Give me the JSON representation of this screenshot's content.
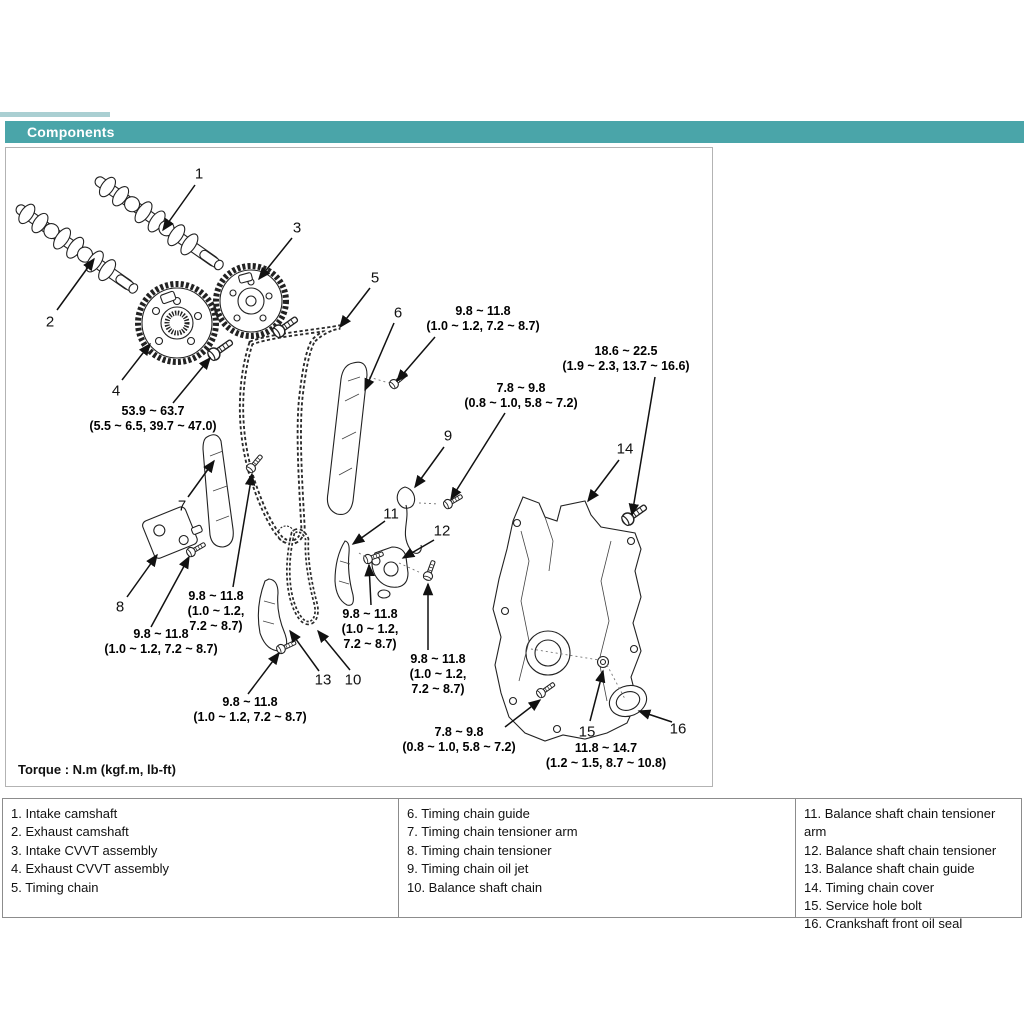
{
  "header": {
    "title": "Components",
    "bar_color": "#4aa5a9",
    "text_color": "#ffffff"
  },
  "diagram": {
    "torque_note": "Torque : N.m (kgf.m, lb-ft)",
    "callouts": [
      {
        "n": "1",
        "x": 198,
        "y": 173,
        "arrow": [
          194,
          184,
          162,
          229
        ]
      },
      {
        "n": "2",
        "x": 49,
        "y": 321,
        "arrow": [
          56,
          309,
          93,
          258
        ]
      },
      {
        "n": "3",
        "x": 296,
        "y": 227,
        "arrow": [
          291,
          237,
          258,
          278
        ]
      },
      {
        "n": "4",
        "x": 115,
        "y": 390,
        "arrow": [
          121,
          379,
          149,
          343
        ]
      },
      {
        "n": "5",
        "x": 374,
        "y": 277,
        "arrow": [
          369,
          287,
          339,
          326
        ]
      },
      {
        "n": "6",
        "x": 397,
        "y": 312,
        "arrow": [
          393,
          322,
          364,
          389
        ]
      },
      {
        "n": "7",
        "x": 181,
        "y": 505,
        "arrow": [
          187,
          496,
          213,
          460
        ]
      },
      {
        "n": "8",
        "x": 119,
        "y": 606,
        "arrow": [
          126,
          596,
          156,
          554
        ]
      },
      {
        "n": "9",
        "x": 447,
        "y": 435,
        "arrow": [
          443,
          446,
          414,
          486
        ]
      },
      {
        "n": "10",
        "x": 352,
        "y": 679,
        "arrow": [
          349,
          669,
          317,
          630
        ]
      },
      {
        "n": "11",
        "x": 390,
        "y": 513,
        "arrow": [
          384,
          520,
          352,
          543
        ]
      },
      {
        "n": "12",
        "x": 441,
        "y": 530,
        "arrow": [
          433,
          539,
          402,
          557
        ]
      },
      {
        "n": "13",
        "x": 322,
        "y": 679,
        "arrow": [
          318,
          670,
          289,
          630
        ]
      },
      {
        "n": "14",
        "x": 624,
        "y": 448,
        "arrow": [
          618,
          459,
          587,
          500
        ]
      },
      {
        "n": "15",
        "x": 586,
        "y": 731,
        "arrow": [
          589,
          720,
          602,
          670
        ]
      },
      {
        "n": "16",
        "x": 677,
        "y": 728,
        "arrow": [
          671,
          721,
          638,
          710
        ]
      }
    ],
    "torque_labels": [
      {
        "lines": [
          "53.9 ~ 63.7",
          "(5.5 ~ 6.5, 39.7 ~ 47.0)"
        ],
        "cx": 152,
        "y": 403,
        "arrow": [
          172,
          402,
          209,
          357
        ]
      },
      {
        "lines": [
          "9.8 ~ 11.8",
          "(1.0 ~ 1.2, 7.2 ~ 8.7)"
        ],
        "cx": 482,
        "y": 303,
        "arrow": [
          434,
          336,
          396,
          380
        ]
      },
      {
        "lines": [
          "18.6 ~ 22.5",
          "(1.9 ~ 2.3, 13.7 ~ 16.6)"
        ],
        "cx": 625,
        "y": 343,
        "arrow": [
          654,
          376,
          631,
          514
        ]
      },
      {
        "lines": [
          "7.8 ~ 9.8",
          "(0.8 ~ 1.0, 5.8 ~ 7.2)"
        ],
        "cx": 520,
        "y": 380,
        "arrow": [
          504,
          412,
          450,
          498
        ]
      },
      {
        "lines": [
          "9.8 ~ 11.8",
          "(1.0 ~ 1.2,",
          "7.2 ~ 8.7)"
        ],
        "cx": 215,
        "y": 588,
        "arrow": [
          232,
          586,
          251,
          473
        ]
      },
      {
        "lines": [
          "9.8 ~ 11.8",
          "(1.0 ~ 1.2, 7.2 ~ 8.7)"
        ],
        "cx": 160,
        "y": 626,
        "arrow": [
          150,
          626,
          188,
          556
        ]
      },
      {
        "lines": [
          "9.8 ~ 11.8",
          "(1.0 ~ 1.2,",
          "7.2 ~ 8.7)"
        ],
        "cx": 369,
        "y": 606,
        "arrow": [
          370,
          604,
          368,
          564
        ]
      },
      {
        "lines": [
          "9.8 ~ 11.8",
          "(1.0 ~ 1.2,",
          "7.2 ~ 8.7)"
        ],
        "cx": 437,
        "y": 651,
        "arrow": [
          427,
          649,
          427,
          583
        ]
      },
      {
        "lines": [
          "9.8 ~ 11.8",
          "(1.0 ~ 1.2, 7.2 ~ 8.7)"
        ],
        "cx": 249,
        "y": 694,
        "arrow": [
          247,
          693,
          278,
          652
        ]
      },
      {
        "lines": [
          "7.8 ~ 9.8",
          "(0.8 ~ 1.0, 5.8 ~ 7.2)"
        ],
        "cx": 458,
        "y": 724,
        "arrow": [
          504,
          726,
          539,
          699
        ]
      },
      {
        "lines": [
          "11.8 ~ 14.7",
          "(1.2 ~ 1.5, 8.7 ~ 10.8)"
        ],
        "cx": 605,
        "y": 740,
        "arrow": null
      }
    ]
  },
  "legend": {
    "columns": [
      {
        "items": [
          "1. Intake camshaft",
          "2. Exhaust camshaft",
          "3. Intake CVVT assembly",
          "4. Exhaust CVVT assembly",
          "5. Timing chain"
        ]
      },
      {
        "items": [
          "6. Timing chain guide",
          "7. Timing chain tensioner arm",
          "8. Timing chain tensioner",
          "9. Timing chain oil jet",
          "10. Balance shaft chain"
        ]
      },
      {
        "items": [
          "11. Balance shaft chain tensioner arm",
          "12. Balance shaft chain tensioner",
          "13. Balance shaft chain guide",
          "14. Timing chain cover",
          "15. Service hole bolt",
          "16. Crankshaft front oil seal"
        ]
      }
    ]
  }
}
